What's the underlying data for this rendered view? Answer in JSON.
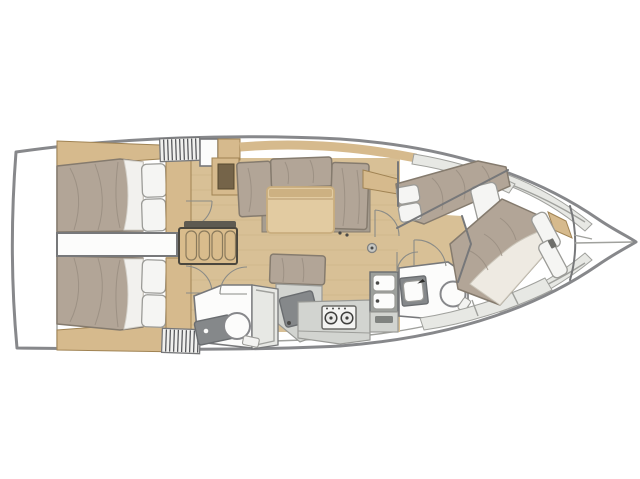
{
  "meta": {
    "title": "Sailing yacht interior layout plan",
    "description": "Top-down deck plan of a sailing monohull interior, bow pointing right, no text labels in drawing",
    "orientation": "bow-right",
    "background": "#ffffff"
  },
  "colors": {
    "background": "#ffffff",
    "hull_outline": "#87888b",
    "deck_line": "#a0a19d",
    "light_gray": "#e7e8e4",
    "wall": "#77787a",
    "door_arc": "#8a8b87",
    "wood_floor": "#d8c096",
    "floor_line": "#c2a778",
    "wood_trim": "#d6ba8d",
    "wood_dark": "#a08353",
    "table": "#e2cba1",
    "table_edge": "#c9ad7d",
    "mattress": "#b2a597",
    "mattress_line": "#978c7f",
    "mattress_stroke": "#857b6e",
    "seat_shadow": "#a69d90",
    "pillow": "#f5f5f3",
    "pillow_stroke": "#9b9b97",
    "sheet": "#f2f1ee",
    "blanket": "#eeeae2",
    "fixture_white": "#fcfcfb",
    "counter": "#d2d4d0",
    "counter_stroke": "#999a96",
    "dark_panel": "#85888a",
    "dark_panel_stroke": "#6a6d70",
    "sink_dark": "#9da09c",
    "hatch_stripe": "#4e4f53",
    "stairs": "#d9bc8c",
    "stairs_border": "#4b473e",
    "stairs_tread": "#8a7a5c",
    "stairs_bar": "#5e5a51",
    "cabinet_inset": "#756449"
  },
  "rooms": {
    "transom": "Transom / swim platform",
    "aft_cabin_top": "Aft double cabin (starboard)",
    "aft_cabin_bottom": "Aft double cabin (port)",
    "engine": "Engine compartment",
    "companionway": "Companionway hatch and steps",
    "saloon": "Saloon with settee and folding table",
    "chart_area": "Chart desk / nav area",
    "galley": "Galley with twin sinks and two-burner stove",
    "aft_head": "Aft head with toilet, washbasin and shower",
    "forward_head": "Forward head with toilet and washbasin",
    "forward_berth": "Forward diagonal berth",
    "bow_cabin": "Bow double cabin",
    "anchor_locker": "Anchor locker"
  },
  "inventory": {
    "berths": 4,
    "toilets": 2,
    "washbasins": 2,
    "galley_sink_basins": 2,
    "stove_burners": 2,
    "companionway_treads": 4,
    "saloon_tables": 1,
    "door_swings": 7
  }
}
